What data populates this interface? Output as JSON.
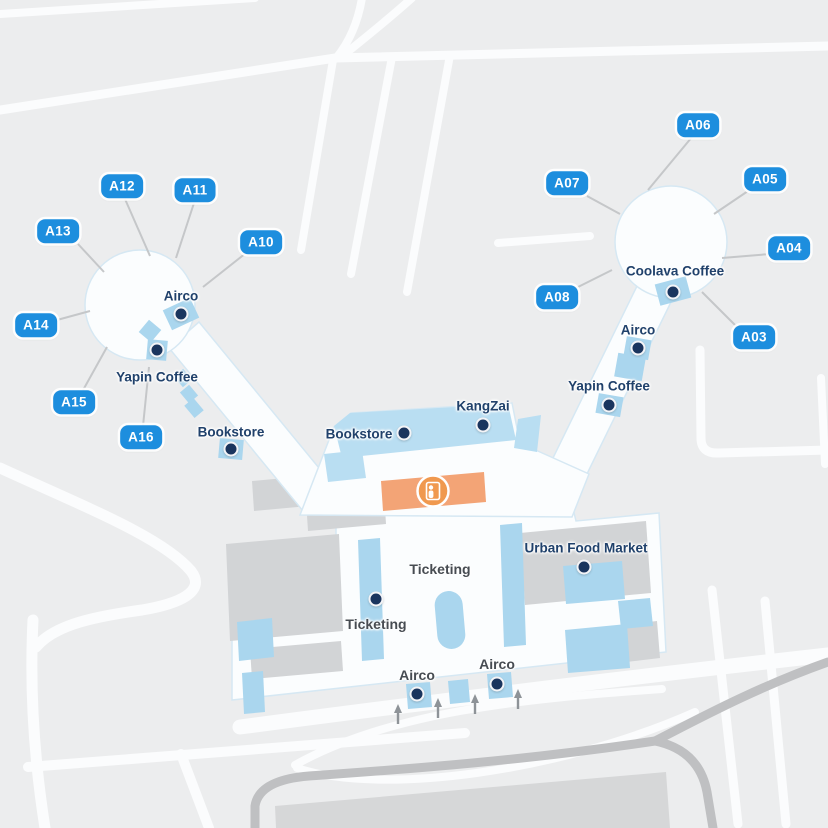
{
  "map": {
    "type": "airport-terminal-map",
    "colors": {
      "background": "#ecedee",
      "gate_badge": "#1d8ede",
      "poi_dot": "#1a355e",
      "amenity_blue": "#aad6ee",
      "concourse_band_blue": "#b9def2",
      "security_orange": "#f3a476",
      "building_gray": "#d2d4d6",
      "road_white": "#fbfcfc",
      "road_dark": "#bfc0c2"
    }
  },
  "gates": [
    {
      "label": "A03"
    },
    {
      "label": "A04"
    },
    {
      "label": "A05"
    },
    {
      "label": "A06"
    },
    {
      "label": "A07"
    },
    {
      "label": "A08"
    },
    {
      "label": "A10"
    },
    {
      "label": "A11"
    },
    {
      "label": "A12"
    },
    {
      "label": "A13"
    },
    {
      "label": "A14"
    },
    {
      "label": "A15"
    },
    {
      "label": "A16"
    }
  ],
  "pois": [
    {
      "label": "Airco",
      "area": "west-pier"
    },
    {
      "label": "Yapin Coffee",
      "area": "west-pier"
    },
    {
      "label": "Bookstore",
      "area": "west-pier"
    },
    {
      "label": "Bookstore",
      "area": "central-concourse"
    },
    {
      "label": "KangZai",
      "area": "central-concourse"
    },
    {
      "label": "Coolava Coffee",
      "area": "east-pier"
    },
    {
      "label": "Airco",
      "area": "east-pier"
    },
    {
      "label": "Yapin Coffee",
      "area": "east-pier"
    },
    {
      "label": "Urban Food Market",
      "area": "terminal"
    },
    {
      "label": "Ticketing",
      "area": "terminal"
    },
    {
      "label": "Ticketing",
      "area": "terminal"
    },
    {
      "label": "Airco",
      "area": "terminal"
    },
    {
      "label": "Airco",
      "area": "terminal"
    }
  ],
  "icons": [
    {
      "name": "security-checkpoint-icon",
      "meaning": "security screening point"
    }
  ]
}
